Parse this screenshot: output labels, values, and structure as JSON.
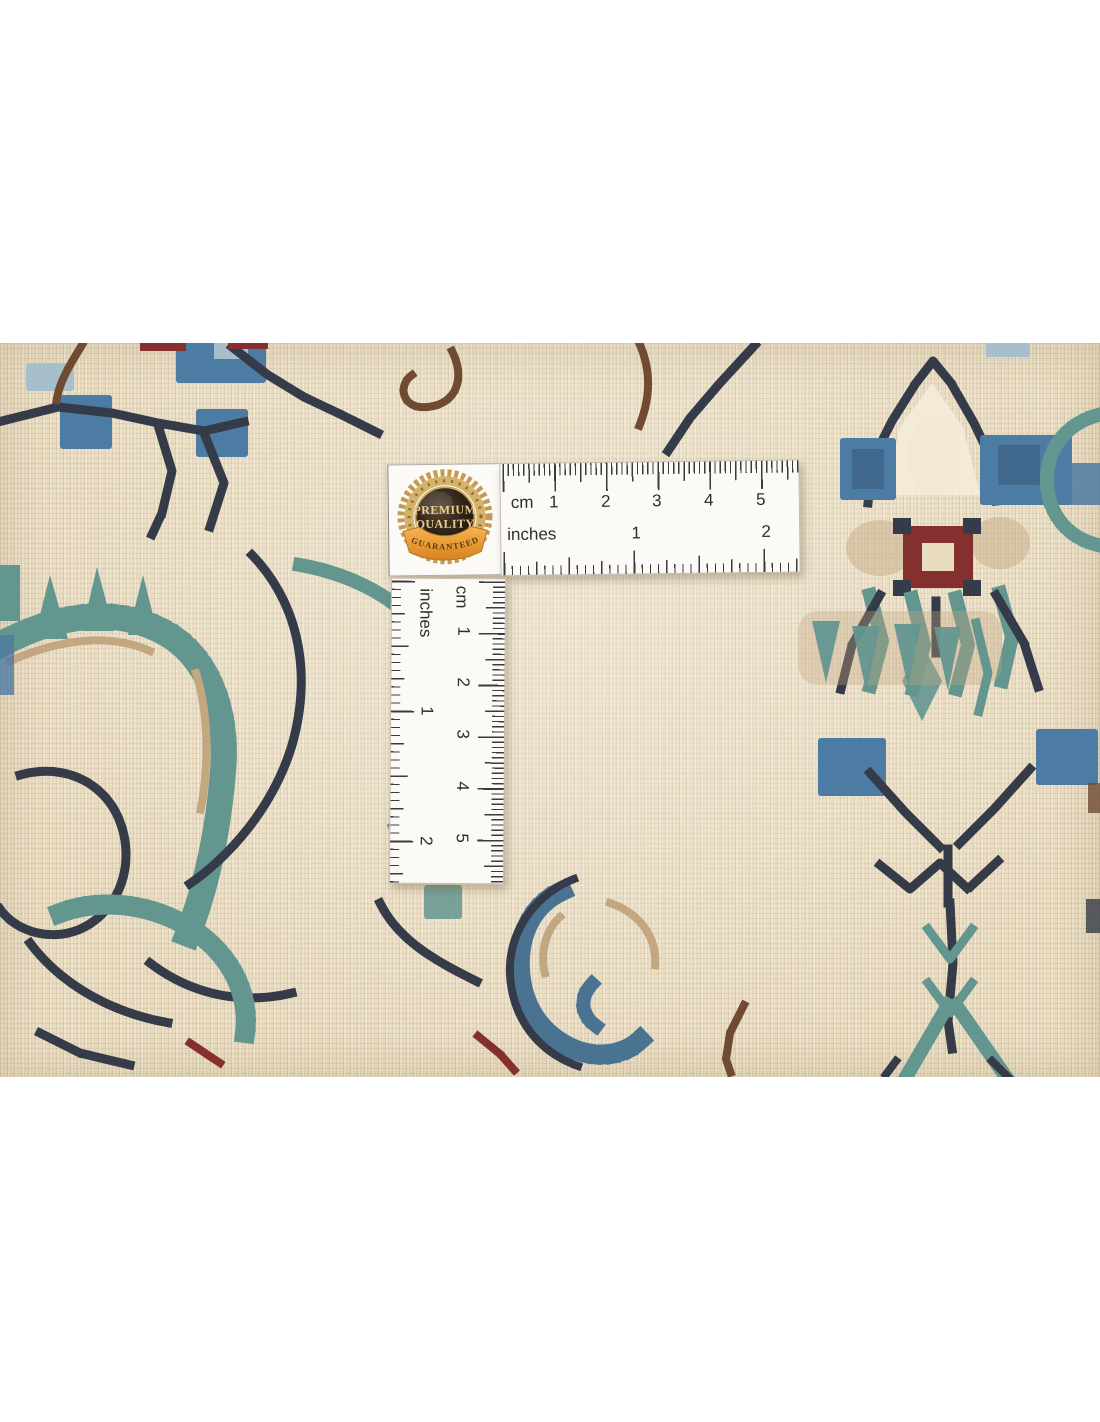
{
  "badge": {
    "line1": "PREMIUM",
    "line2": "QUALITY",
    "ribbon": "GUARANTEED"
  },
  "ruler_h": {
    "unit_cm": "cm",
    "unit_in": "inches",
    "cm_numbers": [
      "1",
      "2",
      "3",
      "4",
      "5"
    ],
    "inch_numbers": [
      "1",
      "2"
    ]
  },
  "ruler_v": {
    "unit_cm": "cm",
    "unit_in": "inches",
    "cm_numbers": [
      "1",
      "2",
      "3",
      "4",
      "5"
    ],
    "inch_numbers": [
      "1",
      "2"
    ]
  },
  "colors": {
    "page-bg": "#ffffff",
    "rug-cream": "#e9dcc1",
    "rug-cream-light": "#f4ecd9",
    "stitch-navy": "#353b48",
    "stitch-blue": "#4c7ba3",
    "stitch-lightblue": "#a6bfca",
    "stitch-teal": "#649690",
    "stitch-teal-blue": "#4a7392",
    "stitch-brown": "#6f4b34",
    "stitch-red": "#84302e",
    "stitch-tan": "#c3a780",
    "ruler-white": "#fbfaf7",
    "ruler-tick": "#3b3b3b",
    "ruler-text": "#2e2e2e",
    "badge-gold": "#c59a52",
    "badge-text-gold": "#ecd08a"
  }
}
